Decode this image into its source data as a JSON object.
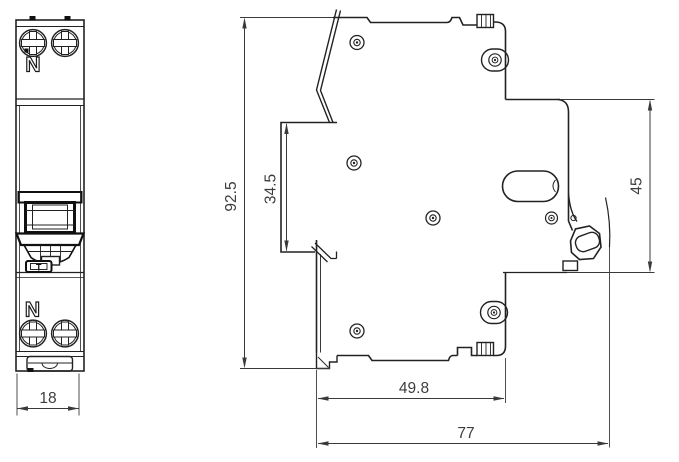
{
  "drawing": {
    "background_color": "#ffffff",
    "line_color": "#222222",
    "dimension_color": "#3d3d3d",
    "front_view": {
      "top_terminal_label": "N",
      "bottom_terminal_label": "N",
      "test_button_label": "T",
      "width_dimension": "18"
    },
    "side_view": {
      "overall_height_dimension": "92.5",
      "recess_height_dimension": "34.5",
      "front_offset_dimension": "45",
      "body_depth_dimension": "49.8",
      "overall_depth_dimension": "77"
    }
  }
}
